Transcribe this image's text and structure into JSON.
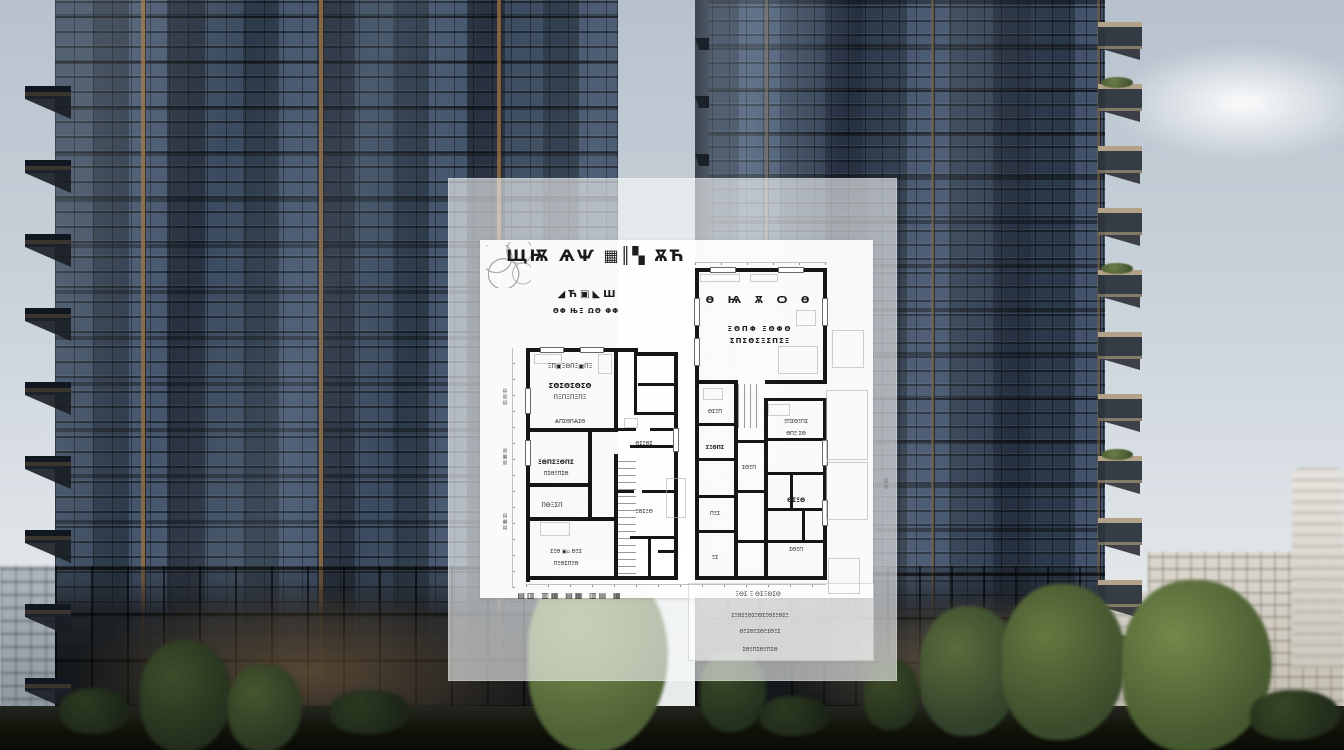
{
  "palette": {
    "sky_top": "#b7c2cd",
    "sky_bottom": "#eceeee",
    "glass_dark": "#2c3949",
    "glass_mid": "#44556c",
    "bronze_accent": "#946d42",
    "balcony_concrete": "#b3a28a",
    "tree_green": "#4e6236",
    "ground_dark": "#101208",
    "overlay_white": "rgba(250,251,252,0.60)",
    "plan_wall": "#161616"
  },
  "floorplan": {
    "walls": [
      [
        78,
        170,
        4,
        234
      ],
      [
        78,
        170,
        112,
        4
      ],
      [
        186,
        174,
        44,
        4
      ],
      [
        226,
        174,
        4,
        228
      ],
      [
        78,
        398,
        152,
        4
      ],
      [
        78,
        250,
        92,
        4
      ],
      [
        166,
        170,
        4,
        84
      ],
      [
        166,
        250,
        22,
        3
      ],
      [
        202,
        250,
        28,
        3
      ],
      [
        78,
        305,
        64,
        4
      ],
      [
        78,
        339,
        90,
        4
      ],
      [
        140,
        254,
        4,
        88
      ],
      [
        166,
        276,
        4,
        126
      ],
      [
        186,
        174,
        3,
        62
      ],
      [
        186,
        234,
        44,
        3
      ],
      [
        190,
        205,
        40,
        3
      ],
      [
        182,
        267,
        48,
        3
      ],
      [
        166,
        312,
        20,
        3
      ],
      [
        194,
        312,
        36,
        3
      ],
      [
        182,
        358,
        48,
        3
      ],
      [
        200,
        360,
        3,
        42
      ],
      [
        210,
        372,
        16,
        3
      ],
      [
        247,
        90,
        4,
        312
      ],
      [
        247,
        90,
        132,
        4
      ],
      [
        375,
        90,
        4,
        116
      ],
      [
        317,
        202,
        62,
        4
      ],
      [
        247,
        202,
        42,
        4
      ],
      [
        286,
        202,
        4,
        200
      ],
      [
        316,
        220,
        4,
        182
      ],
      [
        375,
        220,
        4,
        182
      ],
      [
        316,
        220,
        62,
        3
      ],
      [
        247,
        398,
        132,
        4
      ],
      [
        247,
        245,
        42,
        3
      ],
      [
        247,
        280,
        42,
        3
      ],
      [
        247,
        317,
        42,
        3
      ],
      [
        247,
        352,
        42,
        3
      ],
      [
        319,
        260,
        58,
        3
      ],
      [
        319,
        294,
        58,
        3
      ],
      [
        319,
        330,
        58,
        3
      ],
      [
        319,
        362,
        58,
        3
      ],
      [
        342,
        294,
        3,
        38
      ],
      [
        354,
        330,
        3,
        34
      ],
      [
        290,
        262,
        26,
        3
      ],
      [
        290,
        312,
        26,
        3
      ],
      [
        290,
        362,
        26,
        3
      ]
    ],
    "windows": [
      [
        92,
        169,
        24,
        6
      ],
      [
        132,
        169,
        24,
        6
      ],
      [
        262,
        89,
        26,
        6
      ],
      [
        330,
        89,
        26,
        6
      ],
      [
        77,
        210,
        6,
        26
      ],
      [
        77,
        262,
        6,
        26
      ],
      [
        246,
        120,
        6,
        28
      ],
      [
        246,
        160,
        6,
        28
      ],
      [
        374,
        120,
        6,
        28
      ],
      [
        374,
        262,
        6,
        26
      ],
      [
        374,
        322,
        6,
        26
      ],
      [
        225,
        250,
        6,
        24
      ]
    ],
    "faint": [
      [
        378,
        212,
        42,
        70
      ],
      [
        378,
        284,
        42,
        58
      ],
      [
        384,
        152,
        32,
        38
      ],
      [
        86,
        176,
        28,
        10
      ],
      [
        150,
        176,
        14,
        20
      ],
      [
        252,
        96,
        40,
        8
      ],
      [
        302,
        96,
        28,
        8
      ],
      [
        92,
        344,
        30,
        14
      ],
      [
        255,
        210,
        20,
        12
      ],
      [
        320,
        226,
        22,
        12
      ],
      [
        176,
        240,
        14,
        10
      ],
      [
        330,
        168,
        40,
        28
      ],
      [
        380,
        380,
        32,
        36
      ],
      [
        218,
        300,
        20,
        40
      ],
      [
        348,
        132,
        20,
        16
      ],
      [
        426,
        150,
        18,
        60
      ],
      [
        426,
        240,
        18,
        80
      ],
      [
        426,
        340,
        18,
        50
      ]
    ],
    "labels": [
      {
        "x": 148,
        "y": 70,
        "s": 16,
        "t": "ЩѬ ѦѰ ▦║▚ ѪЋ",
        "b": 1,
        "ls": 2,
        "c": 1
      },
      {
        "x": 140,
        "y": 112,
        "s": 10,
        "t": "◢Ћ▣◣Ш",
        "b": 1,
        "ls": 3,
        "c": 1
      },
      {
        "x": 138,
        "y": 130,
        "s": 7,
        "t": "ΘΦ ЊΞ ΩΘ ΦΦ",
        "b": 1,
        "ls": 1,
        "c": 1
      },
      {
        "x": 312,
        "y": 118,
        "s": 10,
        "t": "Ѳ Ѩ Ѫ Ѻ Ѳ",
        "b": 1,
        "ls": 5,
        "c": 1
      },
      {
        "x": 312,
        "y": 148,
        "s": 7,
        "t": "ΞΘΠΦ ΞΘΦΘ",
        "b": 1,
        "ls": 2,
        "c": 1
      },
      {
        "x": 312,
        "y": 160,
        "s": 7,
        "t": "ΣΠΣΘΣΞΣΠΣΞ",
        "b": 1,
        "ls": 1,
        "c": 1
      },
      {
        "x": 122,
        "y": 186,
        "s": 6,
        "t": "ΞΠ▣ΞΘΠΞ▣ΠΞ",
        "c": 1
      },
      {
        "x": 122,
        "y": 205,
        "s": 7,
        "t": "ΣΘΣΘΣΘΣΘ",
        "b": 1,
        "c": 1
      },
      {
        "x": 122,
        "y": 217,
        "s": 6,
        "t": "ΠΞΠΞΠΞΠΞ",
        "c": 1
      },
      {
        "x": 122,
        "y": 242,
        "s": 5,
        "t": "ѦΠΣΘΠѦΣΘ",
        "c": 1
      },
      {
        "x": 108,
        "y": 282,
        "s": 6,
        "t": "ΞΘΠΣΞΘΠΣ",
        "b": 1,
        "c": 1
      },
      {
        "x": 108,
        "y": 294,
        "s": 5,
        "t": "ΠΣΘΞΠΣΘ",
        "c": 1
      },
      {
        "x": 108,
        "y": 306,
        "s": 5,
        "t": "ΞΘΠΣΞ",
        "c": 1
      },
      {
        "x": 104,
        "y": 325,
        "s": 6,
        "t": "ΠΘΞΣΠ",
        "c": 1
      },
      {
        "x": 118,
        "y": 372,
        "s": 5,
        "t": "ΣΞΘ ▣▫ ΘΞΣ",
        "c": 1
      },
      {
        "x": 118,
        "y": 384,
        "s": 5,
        "t": "ΠΞΘΣΠΞΘ",
        "c": 1
      },
      {
        "x": 196,
        "y": 264,
        "s": 5,
        "t": "ΘΣΞΘΣ",
        "c": 1
      },
      {
        "x": 196,
        "y": 332,
        "s": 5,
        "t": "ΞΘΣΞΘ",
        "c": 1
      },
      {
        "x": 267,
        "y": 232,
        "s": 5,
        "t": "ΘΣΞΠ",
        "c": 1
      },
      {
        "x": 267,
        "y": 268,
        "s": 5,
        "t": "ΣΞΘΠΣ",
        "b": 1,
        "c": 1
      },
      {
        "x": 348,
        "y": 242,
        "s": 5,
        "t": "ΞΠΣΘΞΠΣ",
        "c": 1
      },
      {
        "x": 348,
        "y": 254,
        "s": 5,
        "t": "ΘΠΞ ΣΘ",
        "c": 1
      },
      {
        "x": 301,
        "y": 288,
        "s": 5,
        "t": "ΣΘΞΠ",
        "c": 1
      },
      {
        "x": 348,
        "y": 320,
        "s": 6,
        "t": "ΘΣΞΘ",
        "b": 1,
        "c": 1
      },
      {
        "x": 267,
        "y": 334,
        "s": 5,
        "t": "ΠΞΣ",
        "c": 1
      },
      {
        "x": 348,
        "y": 370,
        "s": 5,
        "t": "ΣΘΞΠ",
        "c": 1
      },
      {
        "x": 267,
        "y": 378,
        "s": 5,
        "t": "ΞΣ",
        "c": 1
      },
      {
        "x": 122,
        "y": 414,
        "s": 8,
        "t": "▤▥ ▥▦ ▤▦ ▥▤ ▦",
        "b": 1,
        "ls": 2,
        "c": 1,
        "col": "#2e2e2e"
      },
      {
        "x": 310,
        "y": 414,
        "s": 6,
        "t": "ΞΘΣ Ξ ΘΣΞΘΣΘ",
        "c": 1,
        "col": "#3a3a3a"
      },
      {
        "x": 312,
        "y": 436,
        "s": 5,
        "t": "ΣΞΘΣΞΘΣΞΘΣΞΘΣΞΘΣΞ",
        "c": 1,
        "col": "#3a3a3a"
      },
      {
        "x": 312,
        "y": 452,
        "s": 5,
        "t": "ΘΞΣΘΞΣΘΞΣΘΞΣ",
        "c": 1,
        "col": "#3a3a3a"
      },
      {
        "x": 312,
        "y": 470,
        "s": 5,
        "t": "ΣΘΞΠΣΘΞΠΣΘ",
        "c": 1,
        "col": "#3a3a3a"
      },
      {
        "x": 54,
        "y": 210,
        "s": 5,
        "t": "▤▥▤",
        "rot": 1,
        "col": "#555555"
      },
      {
        "x": 54,
        "y": 270,
        "s": 5,
        "t": "▥▦▥",
        "rot": 1,
        "col": "#555555"
      },
      {
        "x": 54,
        "y": 335,
        "s": 5,
        "t": "▤▦▤",
        "rot": 1,
        "col": "#555555"
      },
      {
        "x": 435,
        "y": 300,
        "s": 5,
        "t": "▤▥",
        "rot": 1,
        "col": "#777777"
      }
    ]
  }
}
